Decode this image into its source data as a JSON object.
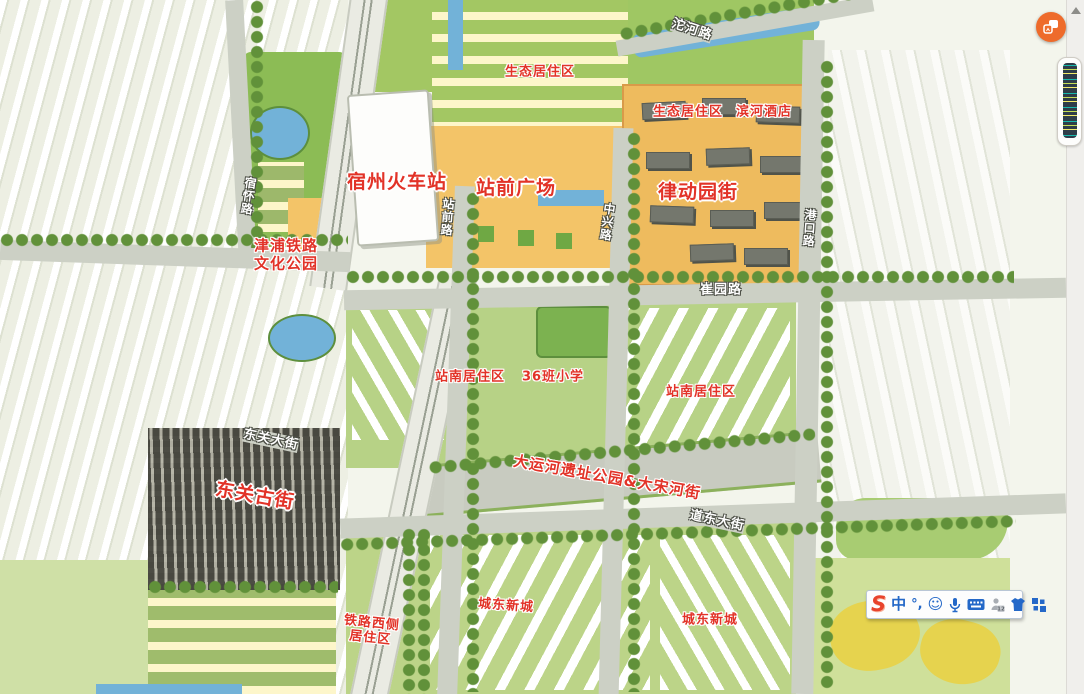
{
  "colors": {
    "label_red": "#e23328",
    "road_label": "#ffffff",
    "ime_blue": "#2468c8",
    "sogou_red": "#e8432c",
    "button_orange": "#ee6b2b",
    "water": "#72b2d8",
    "plaza_orange": "#f3c468",
    "block_orange": "#eebb5e",
    "road_gray": "#ccd0c5",
    "green_base": "#b7d286",
    "tree_green": "#61913a",
    "thumb_navy": "#2e3d49"
  },
  "map": {
    "labels": [
      {
        "text": "沱河路",
        "type": "road",
        "x": 692,
        "y": 30,
        "rot": 18
      },
      {
        "text": "生态居住区",
        "type": "area",
        "x": 540,
        "y": 72
      },
      {
        "text": "生态居住区",
        "type": "area",
        "x": 688,
        "y": 112
      },
      {
        "text": "滨河酒店",
        "type": "area",
        "x": 764,
        "y": 112
      },
      {
        "text": "宿州火车站",
        "type": "major",
        "x": 397,
        "y": 182
      },
      {
        "text": "站前广场",
        "type": "major",
        "x": 516,
        "y": 188
      },
      {
        "text": "律动园街",
        "type": "major",
        "x": 698,
        "y": 192
      },
      {
        "text": "站前路",
        "type": "road-v",
        "x": 447,
        "y": 217,
        "rot": 4
      },
      {
        "text": "中兴路",
        "type": "road-v",
        "x": 607,
        "y": 222,
        "rot": 8
      },
      {
        "text": "港口路",
        "type": "road-v",
        "x": 809,
        "y": 228,
        "rot": 4
      },
      {
        "text": "宿怀路",
        "type": "road-v",
        "x": 248,
        "y": 196,
        "rot": 8
      },
      {
        "text": "津浦铁路\n文化公园",
        "type": "area",
        "x": 286,
        "y": 255,
        "size": 15
      },
      {
        "text": "崔园路",
        "type": "road",
        "x": 721,
        "y": 290
      },
      {
        "text": "站南居住区",
        "type": "area",
        "x": 470,
        "y": 377
      },
      {
        "text": "36班小学",
        "type": "area",
        "x": 553,
        "y": 377
      },
      {
        "text": "站南居住区",
        "type": "area",
        "x": 701,
        "y": 392
      },
      {
        "text": "东关大街",
        "type": "road",
        "x": 271,
        "y": 440,
        "rot": 12
      },
      {
        "text": "东关古街",
        "type": "major",
        "x": 255,
        "y": 496,
        "rot": 10
      },
      {
        "text": "大运河遗址公园&大宋河街",
        "type": "area",
        "x": 607,
        "y": 478,
        "rot": 10,
        "size": 15
      },
      {
        "text": "道东大街",
        "type": "road",
        "x": 717,
        "y": 521,
        "rot": 12
      },
      {
        "text": "城东新城",
        "type": "area",
        "x": 506,
        "y": 606,
        "rot": 4
      },
      {
        "text": "铁路西侧\n居住区",
        "type": "area",
        "x": 371,
        "y": 631,
        "rot": 6
      },
      {
        "text": "城东新城",
        "type": "area",
        "x": 710,
        "y": 620
      }
    ]
  },
  "ui": {
    "floating_button": {
      "icon": "translate-icon"
    },
    "scrollbar": {
      "up_arrow": true
    },
    "ime": {
      "sogou": "S",
      "mode": "中",
      "punct": "°,",
      "smiley": "☺",
      "badge12": "12",
      "icons": [
        "sogou-logo",
        "chinese-mode",
        "punctuation-mode",
        "emoji-icon",
        "microphone-icon",
        "keyboard-icon",
        "calendar-person-icon",
        "skin-icon",
        "toolbox-icon"
      ]
    }
  }
}
